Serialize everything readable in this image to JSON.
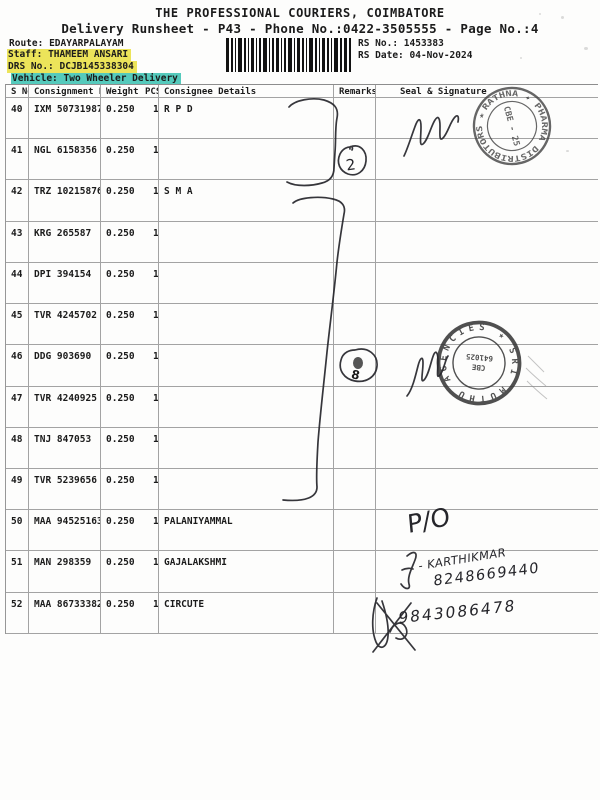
{
  "document": {
    "title": "THE PROFESSIONAL COURIERS, COIMBATORE",
    "subtitle": "Delivery Runsheet - P43 - Phone No.:0422-3505555 - Page No.:4",
    "info": {
      "route_label": "Route:",
      "route_value": "EDAYARPALAYAM",
      "staff_label": "Staff:",
      "staff_value": "THAMEEM ANSARI",
      "drs_label": "DRS No.:",
      "drs_value": "DCJB145338304",
      "vehicle_label": "Vehicle:",
      "vehicle_value": "Two Wheeler Delivery",
      "rs_no_label": "RS No.:",
      "rs_no_value": "1453383",
      "rs_date_label": "RS Date:",
      "rs_date_value": "04-Nov-2024"
    },
    "highlight_colors": {
      "staff": "#ece45a",
      "drs": "#ece45a",
      "vehicle": "#55cabc"
    }
  },
  "table": {
    "headers": [
      "S No",
      "Consignment No",
      "Weight",
      "PCS",
      "Consignee Details",
      "Remarks",
      "Seal & Signature"
    ],
    "rows": [
      {
        "s_no": "40",
        "consignment": "IXM 507319870",
        "weight": "0.250",
        "pcs": "1",
        "consignee": "R P D"
      },
      {
        "s_no": "41",
        "consignment": "NGL 6158356",
        "weight": "0.250",
        "pcs": "1",
        "consignee": ""
      },
      {
        "s_no": "42",
        "consignment": "TRZ 102158768",
        "weight": "0.250",
        "pcs": "1",
        "consignee": "S M A"
      },
      {
        "s_no": "43",
        "consignment": "KRG 265587",
        "weight": "0.250",
        "pcs": "1",
        "consignee": ""
      },
      {
        "s_no": "44",
        "consignment": "DPI 394154",
        "weight": "0.250",
        "pcs": "1",
        "consignee": ""
      },
      {
        "s_no": "45",
        "consignment": "TVR 4245702",
        "weight": "0.250",
        "pcs": "1",
        "consignee": ""
      },
      {
        "s_no": "46",
        "consignment": "DDG 903690",
        "weight": "0.250",
        "pcs": "1",
        "consignee": ""
      },
      {
        "s_no": "47",
        "consignment": "TVR 4240925",
        "weight": "0.250",
        "pcs": "1",
        "consignee": ""
      },
      {
        "s_no": "48",
        "consignment": "TNJ 847053",
        "weight": "0.250",
        "pcs": "1",
        "consignee": ""
      },
      {
        "s_no": "49",
        "consignment": "TVR 5239656",
        "weight": "0.250",
        "pcs": "1",
        "consignee": ""
      },
      {
        "s_no": "50",
        "consignment": "MAA 945251631",
        "weight": "0.250",
        "pcs": "1",
        "consignee": "PALANIYAMMAL"
      },
      {
        "s_no": "51",
        "consignment": "MAN 298359",
        "weight": "0.250",
        "pcs": "1",
        "consignee": "GAJALAKSHMI"
      },
      {
        "s_no": "52",
        "consignment": "MAA 867333829",
        "weight": "0.250",
        "pcs": "1",
        "consignee": "CIRCUTE"
      }
    ]
  },
  "stamps": [
    {
      "ring_text": "RATHNA ✦ PHARMA DISTRIBUTORS ★",
      "center_text": "CBE - 25"
    },
    {
      "ring_text": "SRI MUTHU AGENCIES ★",
      "center_line1": "CBE",
      "center_line2": "641025"
    }
  ],
  "handwriting": {
    "circled_number_rows_40_41": "2",
    "circled_number_row_46": "8",
    "po_note": "P/O",
    "name_note": "- KARTHIKMAR",
    "phone_note": "8248669440",
    "bottom_number": "9843086478"
  }
}
